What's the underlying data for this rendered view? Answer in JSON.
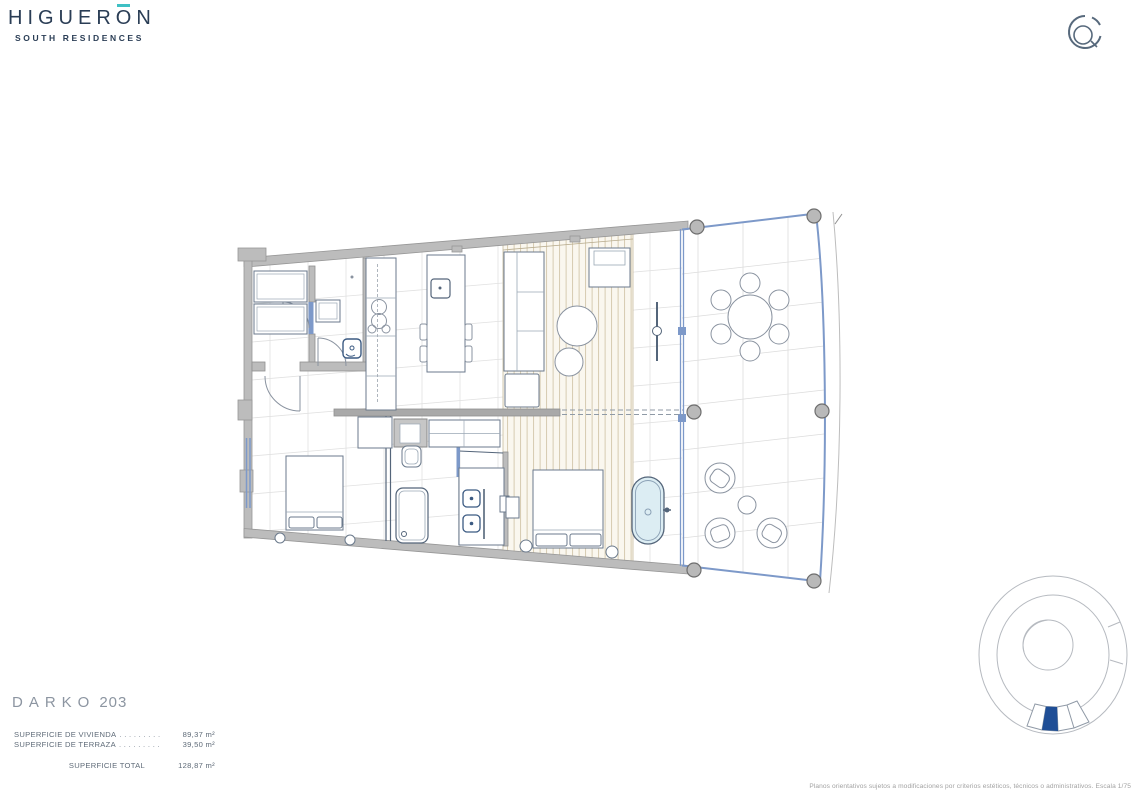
{
  "brand": {
    "name_pre": "HIGUER",
    "name_accent_letter": "O",
    "name_post": "N",
    "subtitle": "SOUTH RESIDENCES"
  },
  "unit": {
    "name": "DARKO",
    "number": "203"
  },
  "areas": {
    "rows": [
      {
        "label": "SUPERFICIE DE VIVIENDA",
        "leader": ". . . . . . . . .",
        "value": "89,37 m²"
      },
      {
        "label": "SUPERFICIE DE TERRAZA",
        "leader": ". . . . . . . . .",
        "value": "39,50 m²"
      }
    ],
    "total": {
      "label": "SUPERFICIE TOTAL",
      "value": "128,87 m²"
    }
  },
  "disclaimer": "Planos orientativos sujetos a modificaciones por criterios estéticos, técnicos o administrativos. Escala 1/75",
  "icons": {
    "top_right": "compass-icon",
    "bottom_right": "site-key-plan-icon"
  },
  "colors": {
    "navy": "#2a3d55",
    "teal_accent": "#3fc0c4",
    "title_gray": "#8c95a1",
    "wall_gray": "#bcbcbc",
    "glass_blue": "#7d99c9",
    "wood_beige": "#d2c6aa",
    "tub_fill": "#dcedf3",
    "unit_highlight": "#1f4e96"
  }
}
